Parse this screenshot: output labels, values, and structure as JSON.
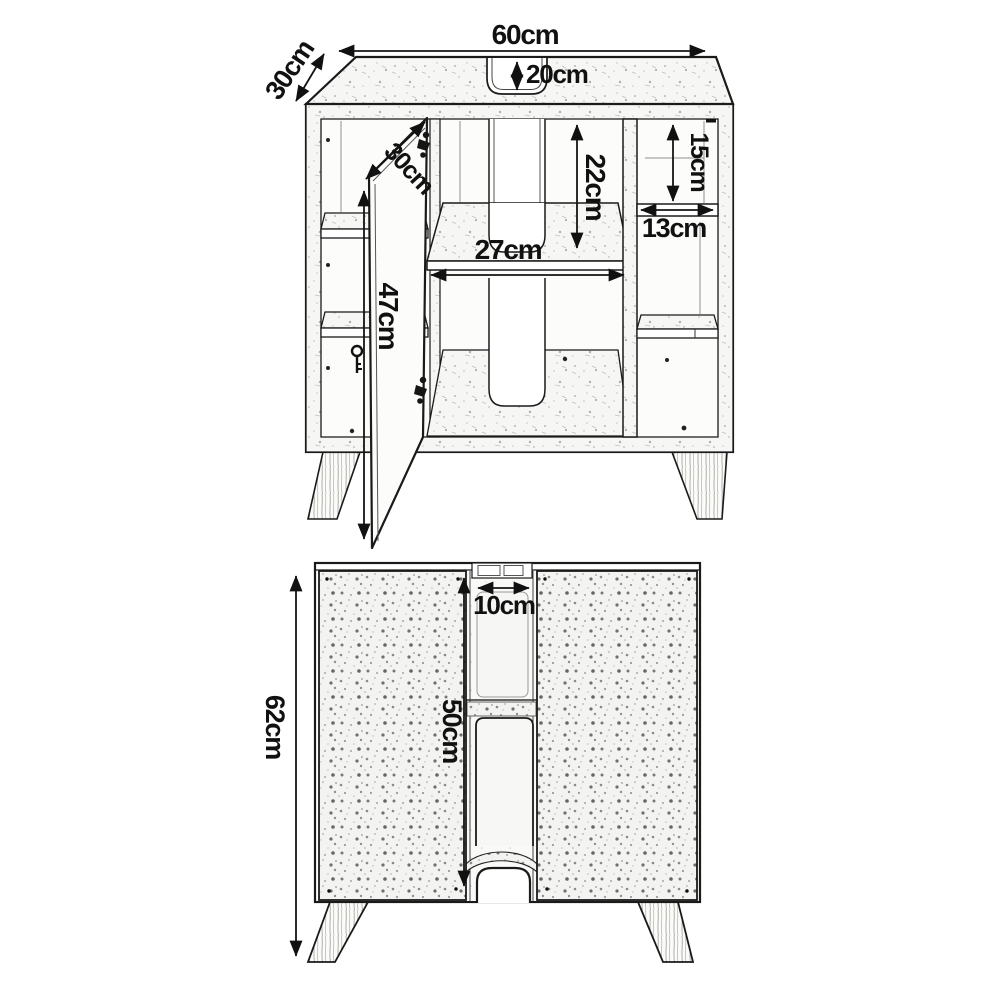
{
  "drawing": {
    "type": "furniture technical drawing",
    "subject": "under-sink bathroom vanity cabinet, perspective view with open door and front view",
    "line_color": "#1a1a1a",
    "background": "#ffffff",
    "perspective_view": {
      "dims": {
        "width": "60cm",
        "depth": "30cm",
        "sink_cutout_depth": "20cm",
        "upper_opening_height": "22cm",
        "middle_shelf_width": "27cm",
        "right_top_compartment_height": "15cm",
        "right_compartment_width": "13cm",
        "door_width": "30cm",
        "door_height": "47cm"
      }
    },
    "front_view": {
      "dims": {
        "overall_height": "62cm",
        "pipe_gap_width": "10cm",
        "door_height": "50cm"
      }
    }
  }
}
